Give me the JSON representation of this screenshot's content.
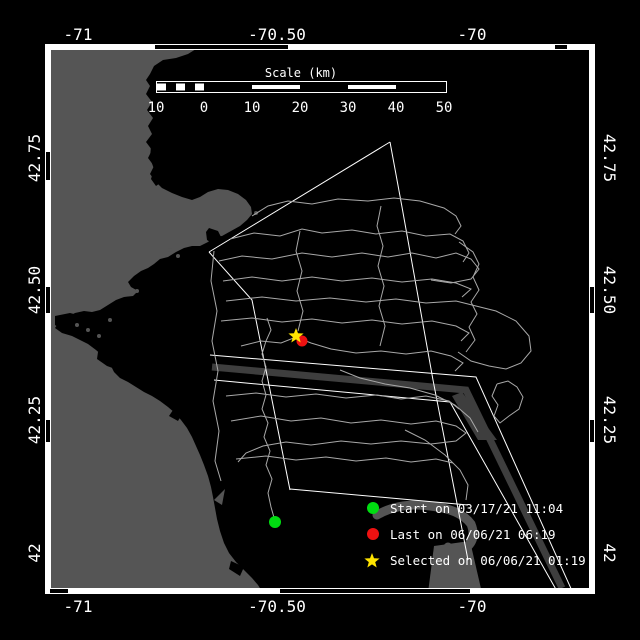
{
  "map": {
    "axis": {
      "top": [
        "-71",
        "-70.50",
        "-70"
      ],
      "bottom": [
        "-71",
        "-70.50",
        "-70"
      ],
      "left": [
        "42.75",
        "42.50",
        "42.25",
        "42"
      ],
      "right": [
        "42.75",
        "42.50",
        "42.25",
        "42"
      ]
    },
    "scalebar": {
      "title": "Scale (km)",
      "ticks": [
        "10",
        "0",
        "10",
        "20",
        "30",
        "40",
        "50"
      ]
    },
    "legend": [
      {
        "marker": "circle",
        "color": "#00dd11",
        "label": "Start on 03/17/21 11:04"
      },
      {
        "marker": "circle",
        "color": "#ee1111",
        "label": "Last on 06/06/21 06:19"
      },
      {
        "marker": "star",
        "color": "#ffe400",
        "label": "Selected on 06/06/21 01:19"
      }
    ],
    "markers": {
      "start": {
        "x": 275,
        "y": 522,
        "color": "#00dd11"
      },
      "last": {
        "x": 302,
        "y": 341,
        "color": "#ee1111"
      },
      "selected": {
        "x": 296,
        "y": 336,
        "color": "#ffe400"
      }
    },
    "colors": {
      "background": "#000000",
      "land": "#555555",
      "water": "#000000",
      "track": "#a8a8a8",
      "boundary": "#ffffff",
      "separation_zone": "#3e3e3e",
      "frame": "#ffffff"
    }
  }
}
